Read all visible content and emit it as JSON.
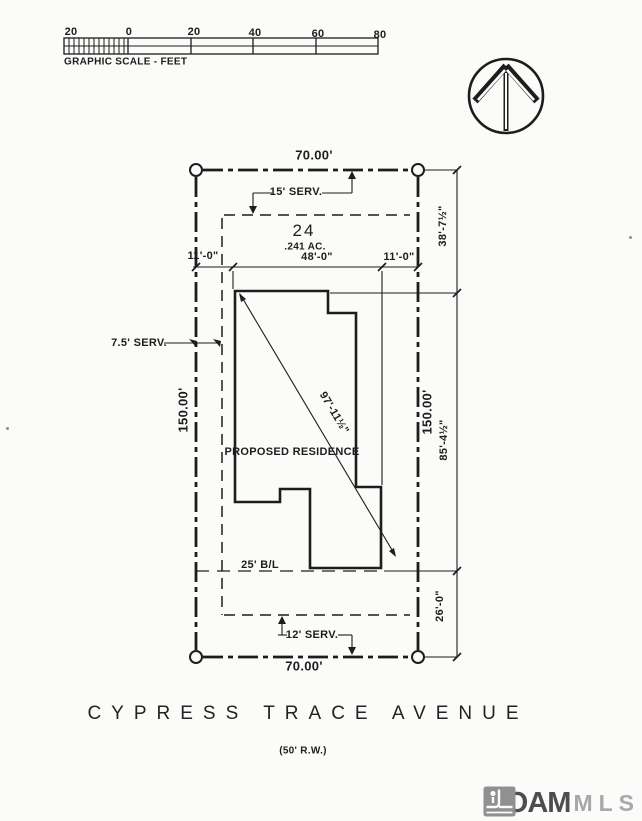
{
  "colors": {
    "ink": "#1d1d1d",
    "paper": "#fbfbf9",
    "logo_dark": "#4c4d4f",
    "logo_light": "#a6a8ab",
    "logo_icon": "#8e9092"
  },
  "scale_bar": {
    "ticks": [
      "20",
      "0",
      "20",
      "40",
      "60",
      "80"
    ],
    "caption": "GRAPHIC SCALE - FEET"
  },
  "lot": {
    "number": "24",
    "acreage": ".241 AC.",
    "residence_label": "PROPOSED RESIDENCE"
  },
  "dimensions": {
    "top_width": "70.00'",
    "bottom_width": "70.00'",
    "left_depth": "150.00'",
    "right_depth": "150.00'",
    "front_left": "11'-0\"",
    "front_center": "48'-0\"",
    "front_right": "11'-0\"",
    "right_upper": "38'-7½\"",
    "right_middle": "85'-4½\"",
    "right_lower": "26'-0\"",
    "diagonal": "97'-11½\""
  },
  "servitudes": {
    "top": "15' SERV.",
    "left": "7.5' SERV.",
    "bottom": "12' SERV.",
    "building_line": "25' B/L"
  },
  "street": {
    "name": "CYPRESS TRACE AVENUE",
    "right_of_way": "(50' R.W.)"
  },
  "logo": {
    "name": "ROAM",
    "suffix": "MLS"
  }
}
